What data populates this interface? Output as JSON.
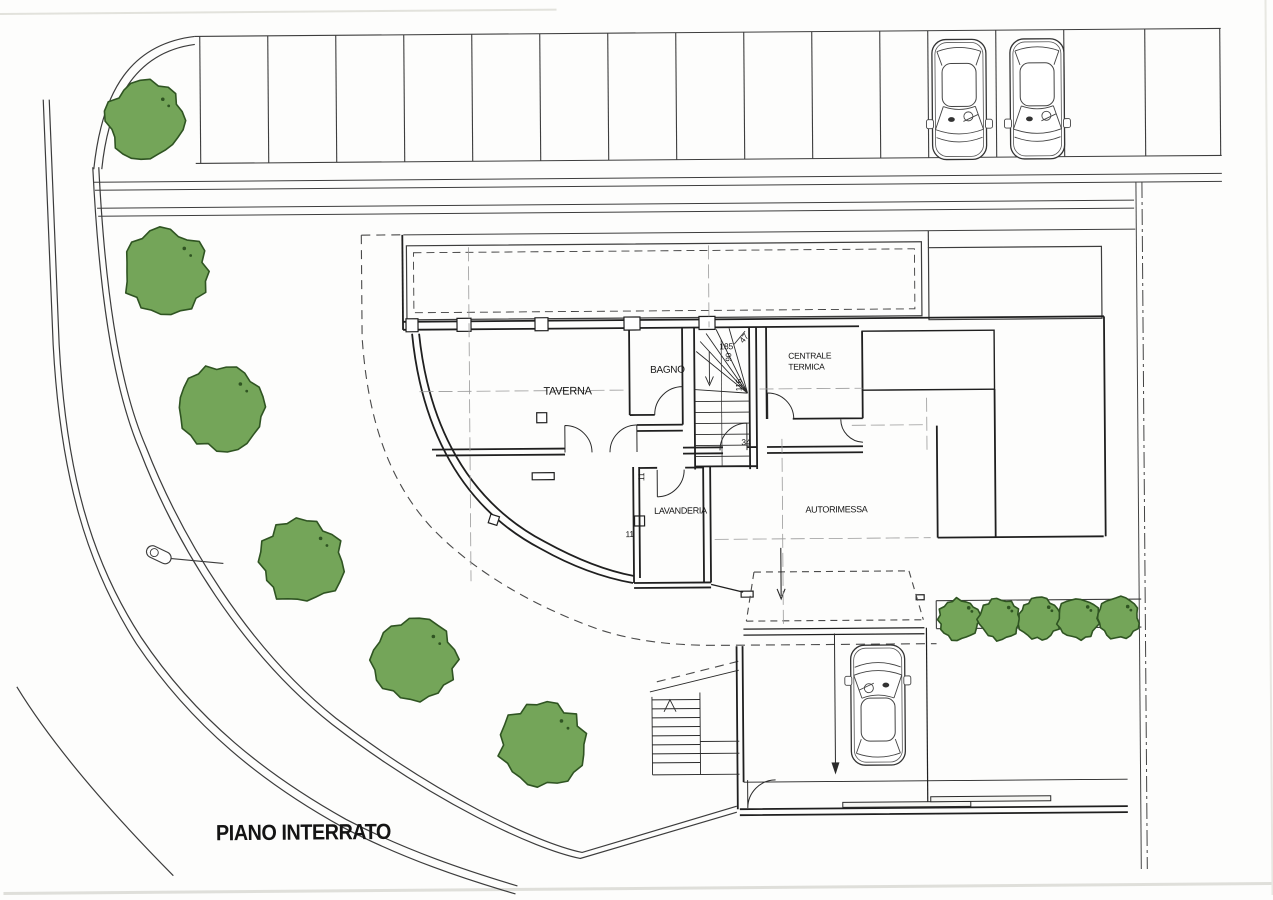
{
  "plan_title": {
    "label": "PIANO INTERRATO",
    "x": 213,
    "y": 837,
    "size": 22
  },
  "colors": {
    "wall": "#1f1f1f",
    "thin": "#3d3d3d",
    "site": "#3c3c3c",
    "axis": "#9a9a9a",
    "dashed": "#4a4a4a",
    "tree_fill": "#74a559",
    "tree_stroke": "#2f5422",
    "paper": "#fdfdfc"
  },
  "rooms": [
    {
      "id": "taverna",
      "label": "TAVERNA",
      "x": 568,
      "y": 394,
      "size": 11,
      "anchor": "middle"
    },
    {
      "id": "bagno",
      "label": "BAGNO",
      "x": 668,
      "y": 373,
      "size": 10,
      "anchor": "middle"
    },
    {
      "id": "centrale-termica",
      "label": "CENTRALE",
      "x": 789,
      "y": 360,
      "size": 8.5,
      "anchor": "start"
    },
    {
      "id": "centrale-termica-2",
      "label": "TERMICA",
      "x": 789,
      "y": 371,
      "size": 8.5,
      "anchor": "start"
    },
    {
      "id": "lavanderia",
      "label": "LAVANDERIA",
      "x": 680,
      "y": 514,
      "size": 9,
      "anchor": "middle"
    },
    {
      "id": "autorimessa",
      "label": "AUTORIMESSA",
      "x": 836,
      "y": 514,
      "size": 9,
      "anchor": "middle"
    }
  ],
  "dimensions": [
    {
      "label": "185",
      "x": 727,
      "y": 350,
      "rot": 0,
      "size": 8.5
    },
    {
      "label": "47",
      "x": 747,
      "y": 341,
      "rot": -50,
      "size": 8.5
    },
    {
      "label": "90",
      "x": 732,
      "y": 358,
      "rot": -90,
      "size": 8
    },
    {
      "label": "116",
      "x": 742,
      "y": 386,
      "rot": -90,
      "size": 8
    },
    {
      "label": "34",
      "x": 746,
      "y": 446,
      "rot": 0,
      "size": 8.5
    },
    {
      "label": "11",
      "x": 644,
      "y": 477,
      "rot": -90,
      "size": 8.5
    },
    {
      "label": "11",
      "x": 629,
      "y": 537,
      "rot": 0,
      "size": 8.5
    }
  ],
  "trees": [
    {
      "cx": 148,
      "cy": 117,
      "r": 39,
      "seed": 3
    },
    {
      "cx": 167,
      "cy": 268,
      "r": 42,
      "seed": 7
    },
    {
      "cx": 222,
      "cy": 404,
      "r": 42,
      "seed": 11
    },
    {
      "cx": 301,
      "cy": 559,
      "r": 42,
      "seed": 17
    },
    {
      "cx": 413,
      "cy": 658,
      "r": 42,
      "seed": 23
    },
    {
      "cx": 540,
      "cy": 744,
      "r": 43,
      "seed": 29
    }
  ],
  "bushes": [
    {
      "cx": 958,
      "cy": 622,
      "r": 21,
      "seed": 31
    },
    {
      "cx": 998,
      "cy": 622,
      "r": 21,
      "seed": 37
    },
    {
      "cx": 1038,
      "cy": 622,
      "r": 21,
      "seed": 41
    },
    {
      "cx": 1077,
      "cy": 622,
      "r": 21,
      "seed": 43
    },
    {
      "cx": 1117,
      "cy": 622,
      "r": 21,
      "seed": 47
    }
  ],
  "cars": [
    {
      "id": "parked-car-1",
      "x": 962,
      "y": 102,
      "rot": 180
    },
    {
      "id": "parked-car-2",
      "x": 1040,
      "y": 102,
      "rot": 180
    },
    {
      "id": "driveway-car",
      "x": 876,
      "y": 707,
      "rot": 0
    }
  ],
  "parking": {
    "divider_x": [
      203,
      271,
      339,
      407,
      475,
      543,
      611,
      679,
      747,
      815,
      883,
      931,
      999,
      1067,
      1148,
      1223
    ],
    "top_y": 33,
    "bottom_y": 160
  }
}
